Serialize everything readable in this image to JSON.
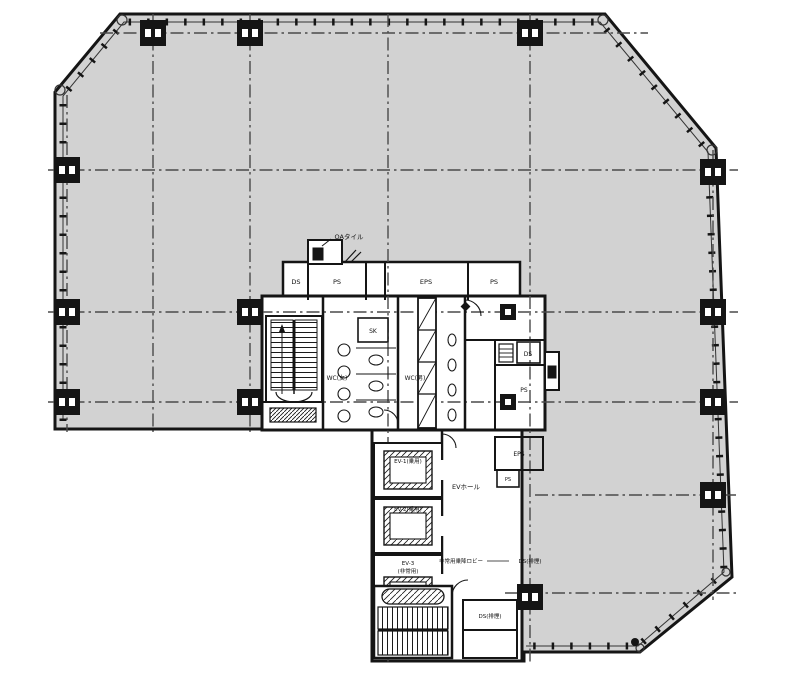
{
  "drawing": {
    "type": "architectural-floor-plan",
    "colors": {
      "floor_fill": "#d2d2d2",
      "wall": "#151515",
      "grid": "#4a4a4a",
      "background": "#ffffff"
    },
    "labels": {
      "top_note": "OAタイル",
      "shafts": {
        "ds1": "DS",
        "ps1": "PS",
        "eps1": "EPS",
        "ps2": "PS",
        "sk": "SK",
        "ds2": "DS",
        "ps4": "PS",
        "eps2": "EPS",
        "ps5": "PS",
        "ds_smoke": "DS(排煙)",
        "ds_leader": "DS(排煙)"
      },
      "wc": {
        "left": "WC(女)",
        "right": "WC(男)"
      },
      "elevators": {
        "ev1": "EV-1(乗用)",
        "ev2": "EV-2(乗用)",
        "ev3a": "EV-3",
        "ev3b": "(非常用)",
        "hall": "EVホール",
        "lobby": "非常用乗降ロビー"
      }
    }
  }
}
